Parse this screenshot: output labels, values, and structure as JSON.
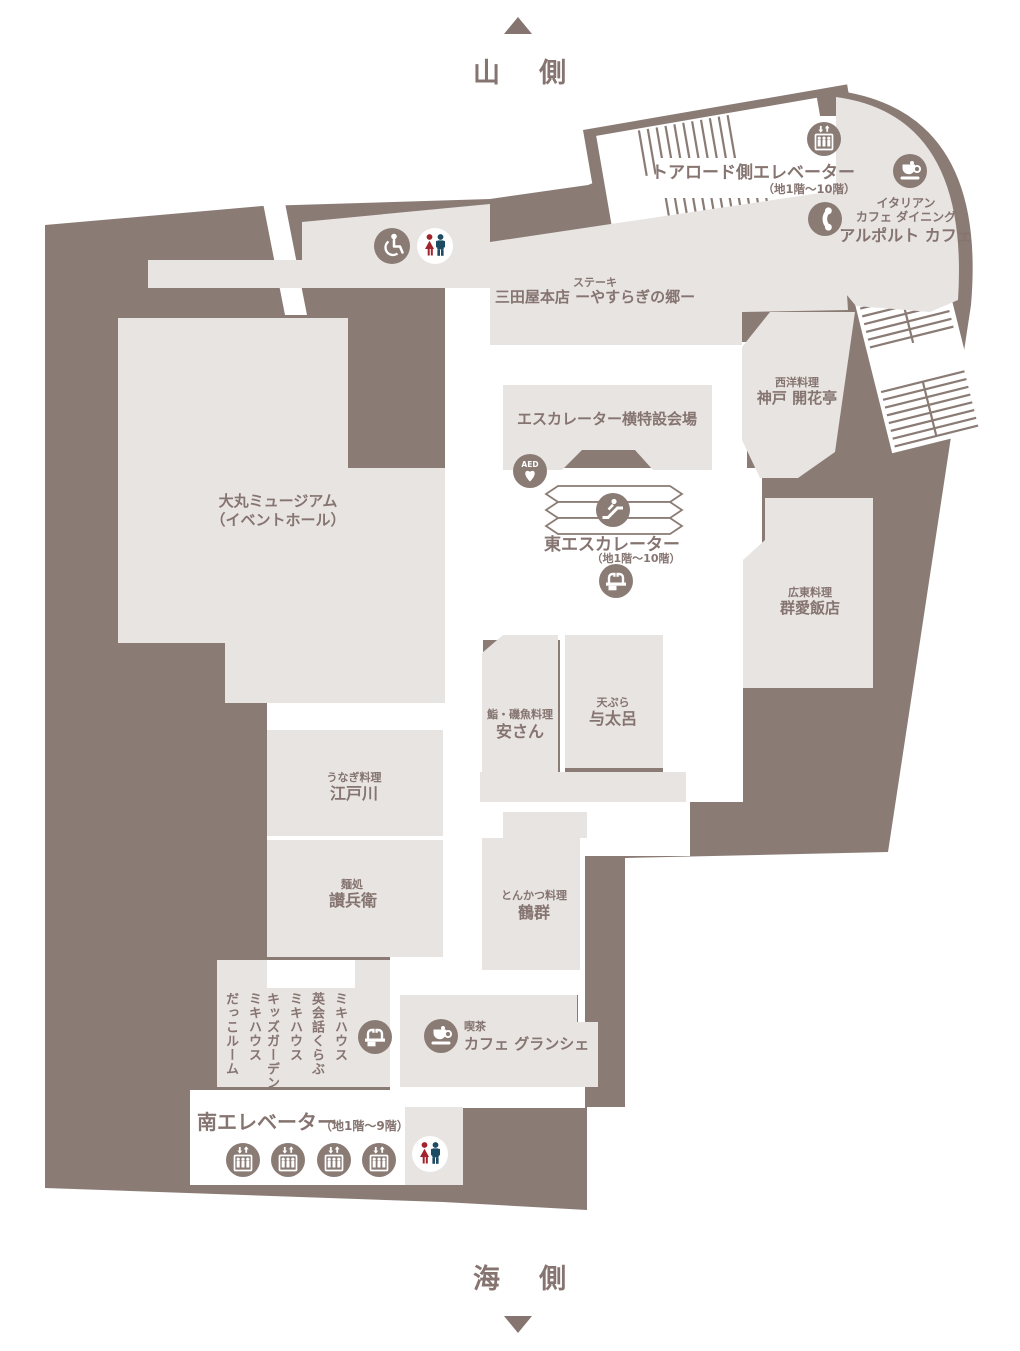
{
  "orientation": {
    "top": "山 側",
    "bottom": "海 側"
  },
  "facilities": {
    "toaroad_elevator": {
      "name": "トアロード側エレベーター",
      "floors": "（地1階〜10階）"
    },
    "east_escalator": {
      "name": "東エスカレーター",
      "floors": "（地1階〜10階）"
    },
    "south_elevator": {
      "name": "南エレベーター",
      "floors": "（地1階〜9階）"
    },
    "event_space": {
      "name": "エスカレーター横特設会場"
    }
  },
  "shops": {
    "alporto": {
      "category1": "イタリアン",
      "category2": "カフェ ダイニング",
      "name": "アルポルト カフェ"
    },
    "sandaya": {
      "category": "ステーキ",
      "name": "三田屋本店 ーやすらぎの郷ー"
    },
    "kaikatei": {
      "category": "西洋料理",
      "name": "神戸 開花亭"
    },
    "gunai": {
      "category": "広東料理",
      "name": "群愛飯店"
    },
    "museum": {
      "name": "大丸ミュージアム",
      "sub": "（イベントホール）"
    },
    "yasusan": {
      "category": "鮨・磯魚料理",
      "name": "安さん"
    },
    "yotaro": {
      "category": "天ぷら",
      "name": "与太呂"
    },
    "edogawa": {
      "category": "うなぎ料理",
      "name": "江戸川"
    },
    "sanbei": {
      "category": "麺処",
      "name": "讃兵衛"
    },
    "tsurumura": {
      "category": "とんかつ料理",
      "name": "鶴群"
    },
    "granche": {
      "category": "喫茶",
      "name": "カフェ グランシェ"
    },
    "miki_eikaiwa": {
      "line1": "ミキハウス",
      "line2": "英会話くらぶ"
    },
    "miki_kids": {
      "line1": "ミキハウス",
      "line2": "キッズガーデン"
    },
    "miki_dakko": {
      "line1": "ミキハウス",
      "line2": "だっこルーム"
    }
  },
  "icons": {
    "aed_label": "AED",
    "elevator": "elevator-icon",
    "phone": "phone-icon",
    "cafe": "coffee-cup-icon",
    "escalator": "escalator-icon",
    "fountain": "water-fountain-icon",
    "wheelchair": "wheelchair-icon",
    "restroom": "restroom-icon"
  },
  "colors": {
    "wall": "#8a7b75",
    "room": "#e8e4e1",
    "text": "#857470",
    "restroom_female": "#a1242c",
    "restroom_male": "#1d4b63",
    "white": "#ffffff"
  }
}
